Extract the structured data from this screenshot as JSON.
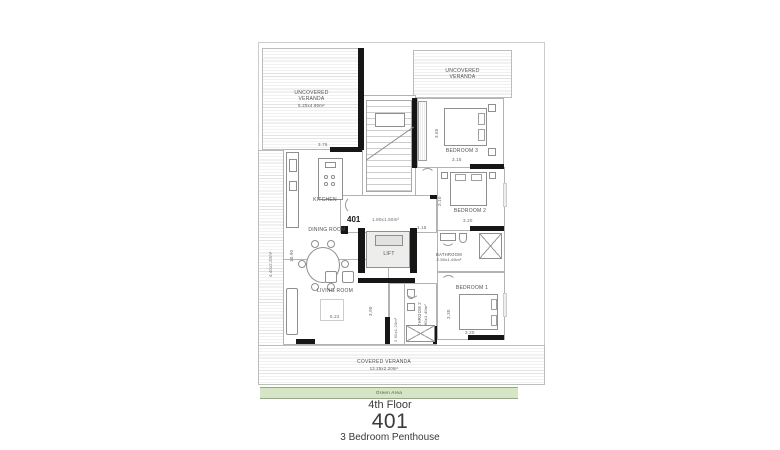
{
  "title": {
    "floor": "4th Floor",
    "unit": "401",
    "subtitle": "3 Bedroom Penthouse"
  },
  "labels": {
    "verandaLeftTop": "UNCOVERED VERANDA",
    "verandaLeftTopDims": "5.20x4.90m²",
    "verandaLeftSideDims": "4.40x2.20m²",
    "verandaRightTop": "UNCOVERED VERANDA",
    "coveredVeranda": "COVERED VERANDA",
    "coveredVerandaDims": "13.25x2.20m²",
    "greenArea": "Green Area",
    "kitchen": "KITCHEN",
    "diningRoom": "DINING ROOM",
    "livingRoom": "LIVING ROOM",
    "lift": "LIFT",
    "unitNumber": "401",
    "entryDims": "1.80x1.50m²",
    "bathroom": "BATHROOM",
    "bathroomDims": "2.50x1.60m²",
    "bathroom2": "BATHROOM 2",
    "bathroom2Dims": "2.60x1.40m²",
    "bedroom1": "BEDROOM 1",
    "bedroom2": "BEDROOM 2",
    "bedroom3": "BEDROOM 3"
  },
  "dims": {
    "kitchenWidth": "3.75",
    "diningHeight": "10.90",
    "livingWidth": "5.22",
    "livingHeight": "3.90",
    "hallWidth": "1.15",
    "corridorDims": "2.60x1.20m²",
    "bedroom1Width": "3.20",
    "bedroom1Height": "3.30",
    "bedroom2Width": "3.20",
    "bedroom2Height": "3.10",
    "bedroom3Width": "3.15",
    "bedroom3Height": "3.65"
  },
  "colors": {
    "wall": "#161616",
    "hatchLine": "#e3e3e3",
    "greenFill": "#d7e5c7",
    "greenBorder": "#8fae77",
    "text": "#4f4f4f"
  }
}
